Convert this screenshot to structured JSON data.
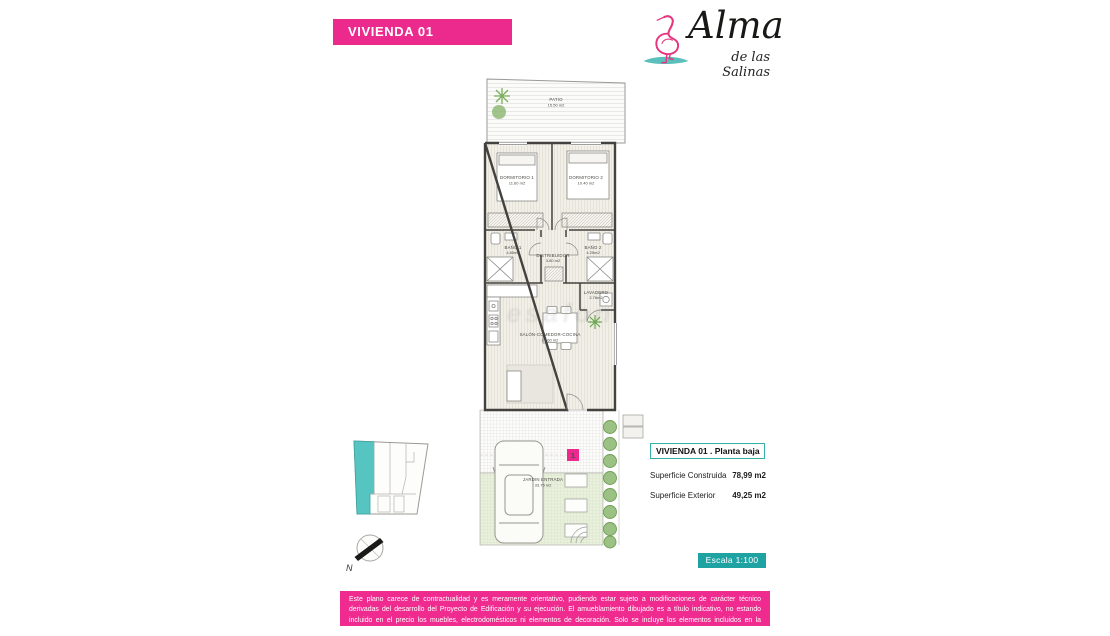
{
  "header": {
    "banner_label": "VIVIENDA 01",
    "logo": {
      "brand": "Alma",
      "tagline": "de las Salinas"
    }
  },
  "plan": {
    "rooms": [
      {
        "name": "PATIO",
        "area": "15.50 m2"
      },
      {
        "name": "DORMITORIO 1",
        "area": "11.60 m2"
      },
      {
        "name": "DORMITORIO 2",
        "area": "10.40 m2"
      },
      {
        "name": "BAÑO 1",
        "area": "4.85m2"
      },
      {
        "name": "DISTRIBUIDOR",
        "area": "3.80 m2"
      },
      {
        "name": "BAÑO 2",
        "area": "4.25m2"
      },
      {
        "name": "LAVADERO",
        "area": "2.76m2"
      },
      {
        "name": "SALÓN-COMEDOR-COCINA",
        "area": "31.60 m2"
      },
      {
        "name": "JARDIN ENTRADA",
        "area": "33.75 m2"
      }
    ],
    "unit_badge": "1",
    "compass_label": "N"
  },
  "info_panel": {
    "title": "VIVIENDA 01 .  Planta baja",
    "rows": [
      {
        "label": "Superficie Construida",
        "value": "78,99 m2"
      },
      {
        "label": "Superficie Exterior",
        "value": "49,25 m2"
      }
    ]
  },
  "scale_badge": "Escala 1:100",
  "watermark": "esafon",
  "disclaimer": "Este plano carece de contractualidad y es meramente orientativo, pudiendo estar sujeto a modificaciones de carácter técnico derivadas del desarrollo del Proyecto de Edificación y su ejecución. El amueblamiento dibujado es a título indicativo, no estando incluido en el precio los muebles, electrodomésticos ni elementos de decoración. Solo se incluye los elementos incluidos en la memoria del Proyecto visado.",
  "colors": {
    "pink": "#EC2A8E",
    "teal": "#1FA2A2",
    "teal_light": "#56C4C0"
  }
}
